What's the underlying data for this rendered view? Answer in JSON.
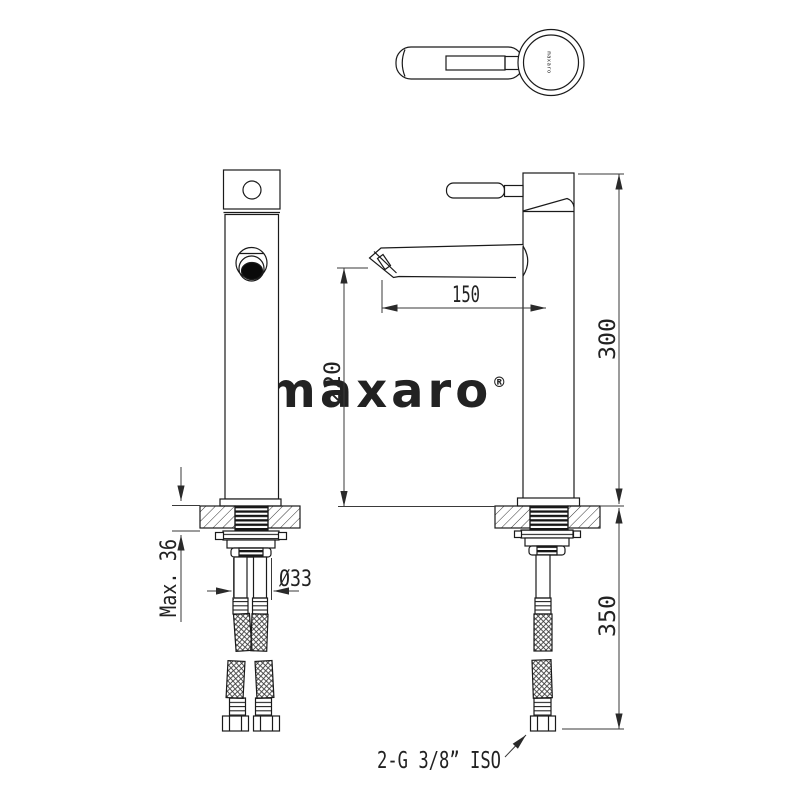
{
  "watermark": {
    "text": "maxaro",
    "reg": "®"
  },
  "top_view": {
    "brand_mark": "maxaro"
  },
  "dimensions": {
    "spout_reach": "150",
    "spout_outlet_height": "220",
    "faucet_height": "300",
    "hose_length": "350",
    "shank_diameter": "Ø33",
    "max_mounting_thickness": "Max. 36",
    "hose_connection": "2-G 3/8” ISO"
  },
  "colors": {
    "line": "#1a1a1a",
    "dimension": "#3a3a3a",
    "watermark": "#ececec",
    "paper": "#ffffff"
  }
}
